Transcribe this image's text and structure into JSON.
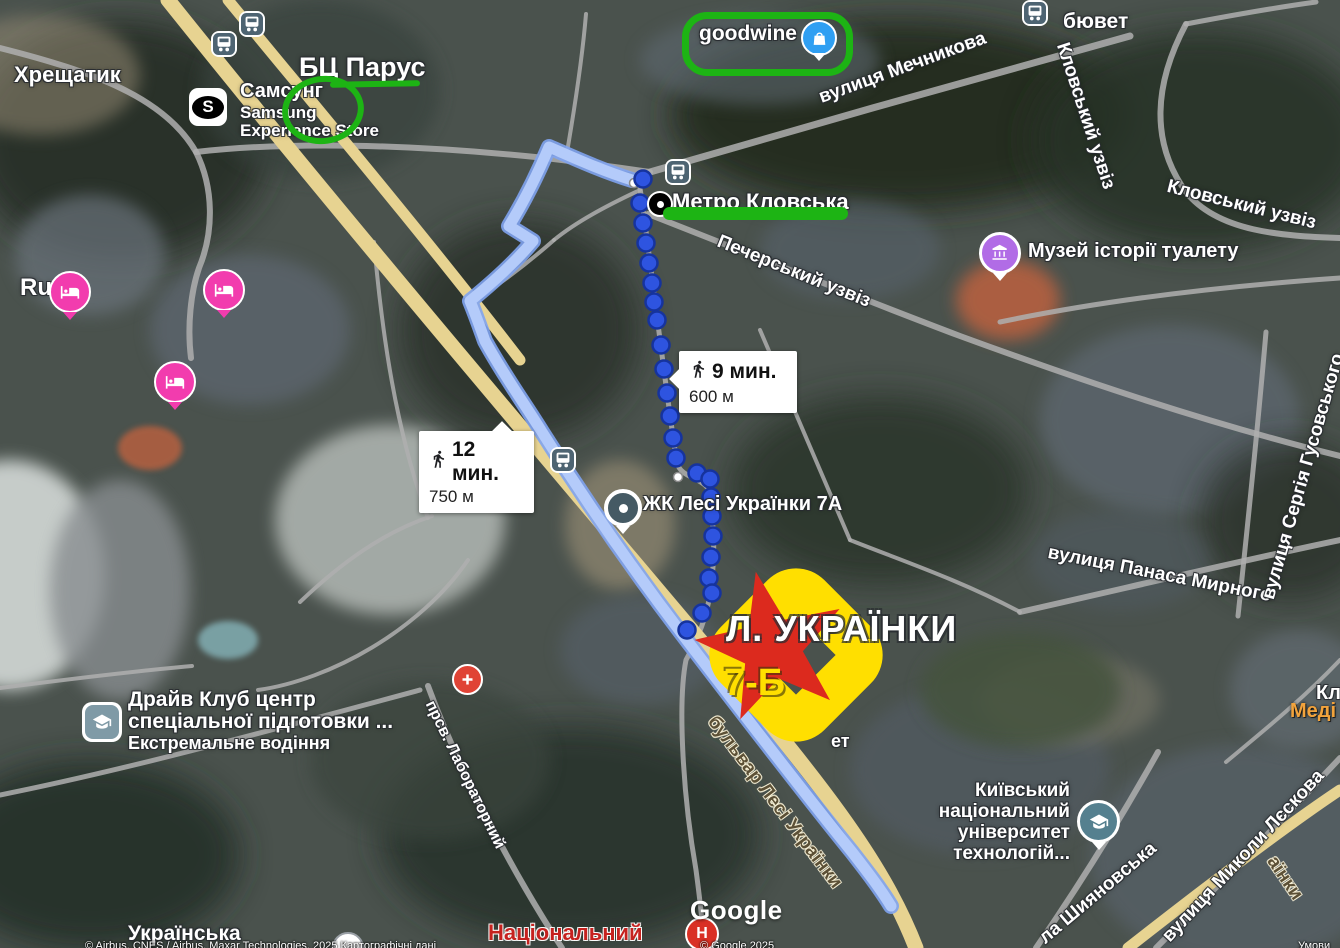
{
  "labels": {
    "khreshchatyk": "Хрещатик",
    "bts_parus": "БЦ Парус",
    "samsung_cyr": "Самсунг",
    "samsung_lat": "Samsung",
    "samsung_store": "Experience Store",
    "samsung_s": "S",
    "goodwine": "goodwine",
    "byuvet": "бювет",
    "mechnykova": "вулиця Мечникова",
    "klovskyi_uzviz_1": "Кловський узвіз",
    "klovskyi_uzviz_2": "Кловський узвіз",
    "metro_klovska": "Метро Кловська",
    "pecherskyi_uzviz": "Печерський узвіз",
    "muzei": "Музей історії туалету",
    "zhk": "ЖК Лесі Українки 7А",
    "panasa_myrnoho": "вулиця Панаса Мирного",
    "husovskoho": "вулиця Сергія Гусовського",
    "rus": "Rus",
    "drive_club_1": "Драйв Клуб центр",
    "drive_club_2": "спеціальної підготовки ...",
    "drive_club_3": "Екстремальне водіння",
    "university_1": "Київський",
    "university_2": "національний",
    "university_3": "університет",
    "university_4": "технологій...",
    "shyianovska": "ла Шияновська",
    "lieskova": "вулиця Миколи Лєскова",
    "laboratornyi": "прсв. Лабораторний",
    "bulvar": "бульвар Лесі Українки",
    "bulvar_frag": "аїнки",
    "natsionalnyi": "Національний",
    "hospital_h": "Н",
    "ukrainska": "Українська",
    "kl_frag": "Кл",
    "medi_frag": "Меді",
    "et_frag": "ет"
  },
  "badges": {
    "walk9": {
      "time": "9 мин.",
      "distance": "600 м"
    },
    "walk12": {
      "time": "12 мин.",
      "distance": "750 м"
    }
  },
  "destination": {
    "line1": "Л. УКРАЇНКИ",
    "line2": "7-Б"
  },
  "watermark": {
    "google": "Google",
    "attribution_left": "© Airbus, CNES / Airbus, Maxar Technologies, 2025 Картографічні дані",
    "attribution_right": "© Google 2025",
    "terms": "Умови"
  },
  "colors": {
    "annotation_green": "#1db414",
    "marker_yellow": "#ffdf00",
    "star_red": "#dc2a1e",
    "route_dot_blue": "#2e54e0",
    "walk_ribbon_blue": "#b4cbfa",
    "hotel_pink": "#f23cae",
    "museum_purple": "#b16ce6",
    "school_teal": "#55808f",
    "medical_red": "#e04335",
    "goodwine_blue": "#2f9ff2"
  },
  "icons": {
    "bus-stop-icon": "bus in rounded square",
    "metro-icon": "black dot",
    "shop-icon": "shopping bag",
    "hotel-icon": "bed",
    "museum-icon": "building with columns",
    "school-icon": "graduation cap",
    "medical-icon": "cross",
    "hospital-icon": "letter H",
    "walk-icon": "pedestrian",
    "samsung-icon": "letter S"
  },
  "route": {
    "dots": [
      {
        "x": 634,
        "y": 183,
        "via": 1
      },
      {
        "x": 643,
        "y": 179
      },
      {
        "x": 640,
        "y": 203
      },
      {
        "x": 643,
        "y": 223
      },
      {
        "x": 646,
        "y": 243
      },
      {
        "x": 649,
        "y": 263
      },
      {
        "x": 652,
        "y": 283
      },
      {
        "x": 654,
        "y": 302
      },
      {
        "x": 657,
        "y": 320
      },
      {
        "x": 661,
        "y": 345
      },
      {
        "x": 664,
        "y": 369
      },
      {
        "x": 667,
        "y": 393
      },
      {
        "x": 670,
        "y": 416
      },
      {
        "x": 673,
        "y": 438
      },
      {
        "x": 676,
        "y": 458
      },
      {
        "x": 678,
        "y": 477,
        "via": 1
      },
      {
        "x": 697,
        "y": 473
      },
      {
        "x": 710,
        "y": 479
      },
      {
        "x": 711,
        "y": 497
      },
      {
        "x": 712,
        "y": 516
      },
      {
        "x": 713,
        "y": 536
      },
      {
        "x": 711,
        "y": 557
      },
      {
        "x": 709,
        "y": 578
      },
      {
        "x": 712,
        "y": 593
      },
      {
        "x": 702,
        "y": 613
      },
      {
        "x": 687,
        "y": 630
      }
    ]
  }
}
